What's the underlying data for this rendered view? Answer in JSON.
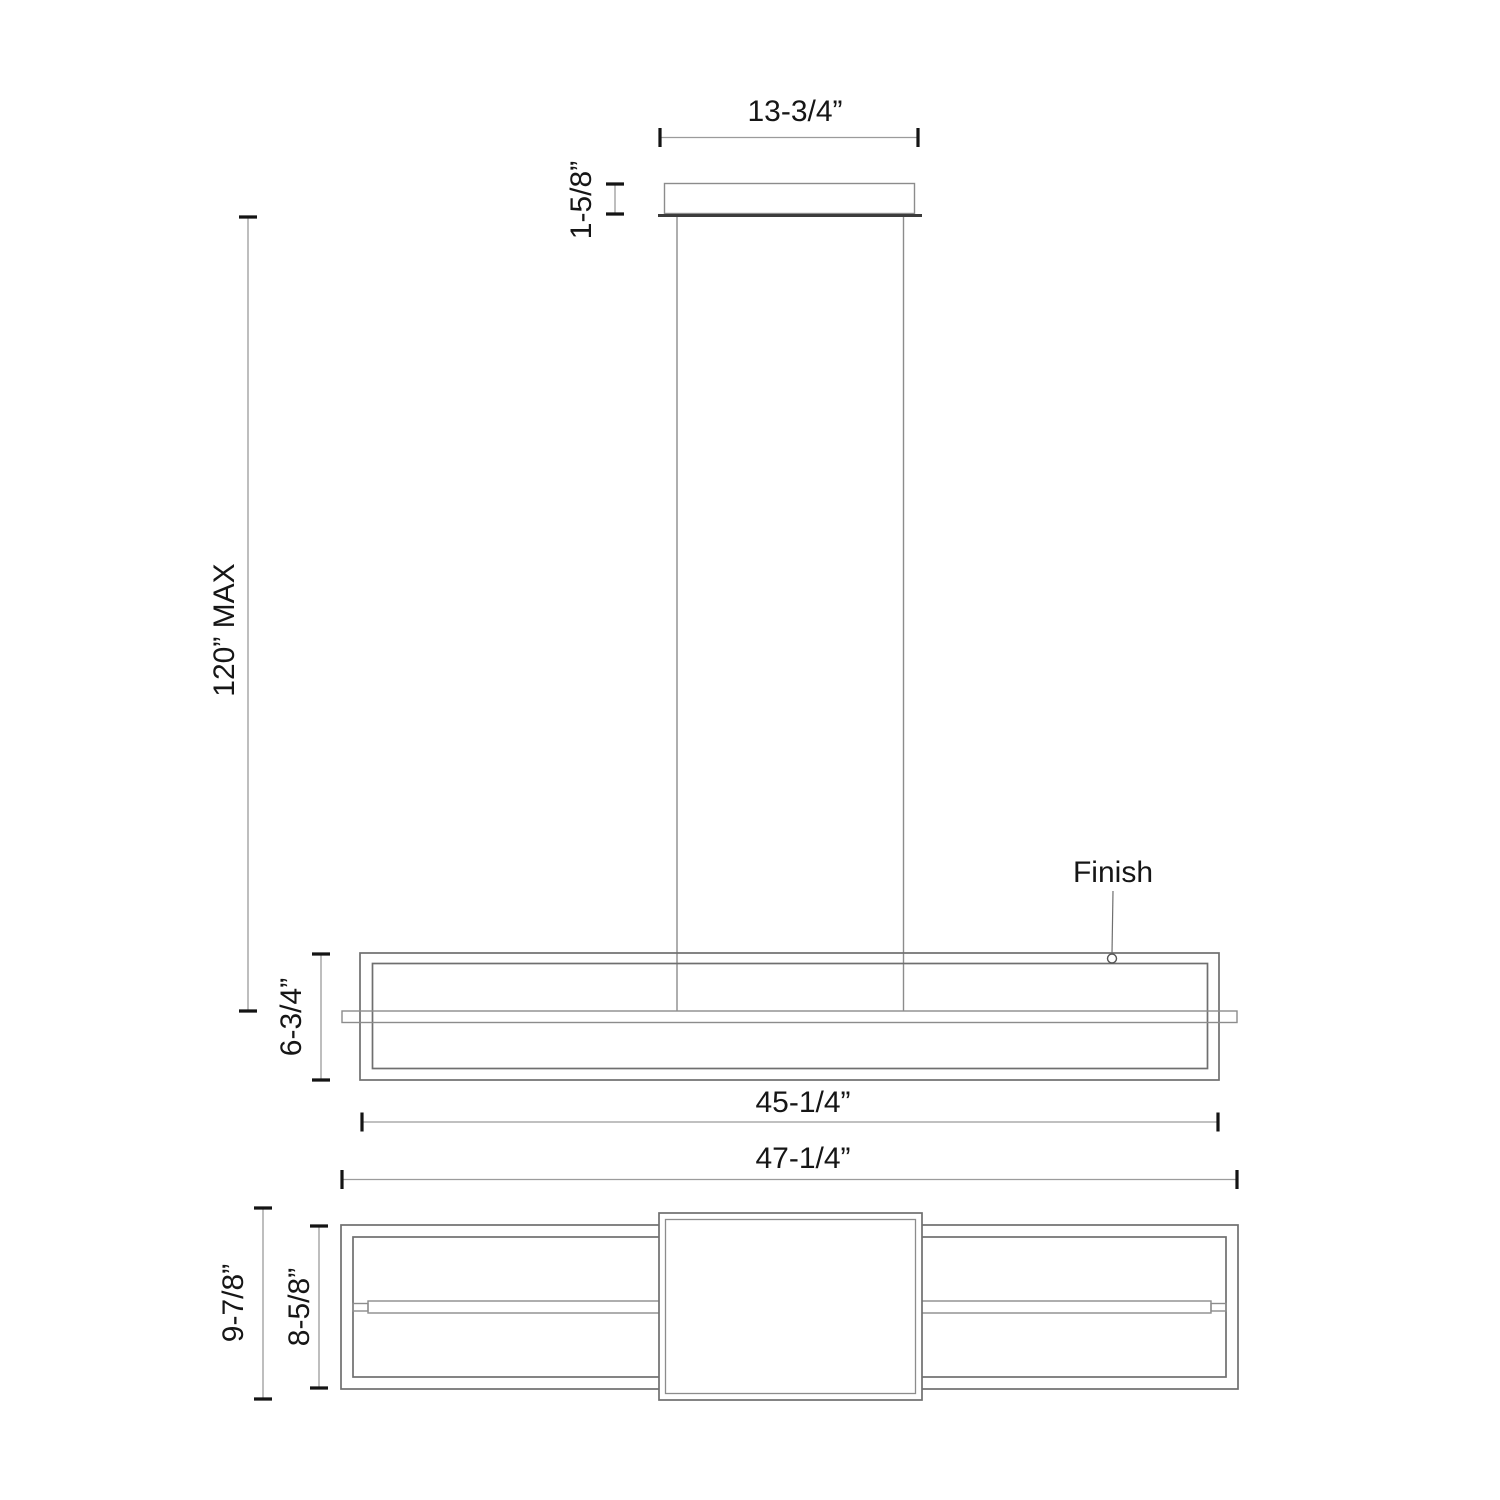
{
  "drawing": {
    "labels": {
      "canopy_width": "13-3/4”",
      "canopy_height": "1-5/8”",
      "suspension_max": "120” MAX",
      "fixture_height": "6-3/4”",
      "fixture_length": "45-1/4”",
      "finish": "Finish",
      "overall_length": "47-1/4”",
      "overall_depth": "9-7/8”",
      "body_depth": "8-5/8”"
    },
    "colors": {
      "background": "#ffffff",
      "geometry_line": "#6f6f6f",
      "light_line": "#8c8c8c",
      "dimension_line": "#9b9b9b",
      "tick": "#141414",
      "text": "#161616"
    }
  }
}
